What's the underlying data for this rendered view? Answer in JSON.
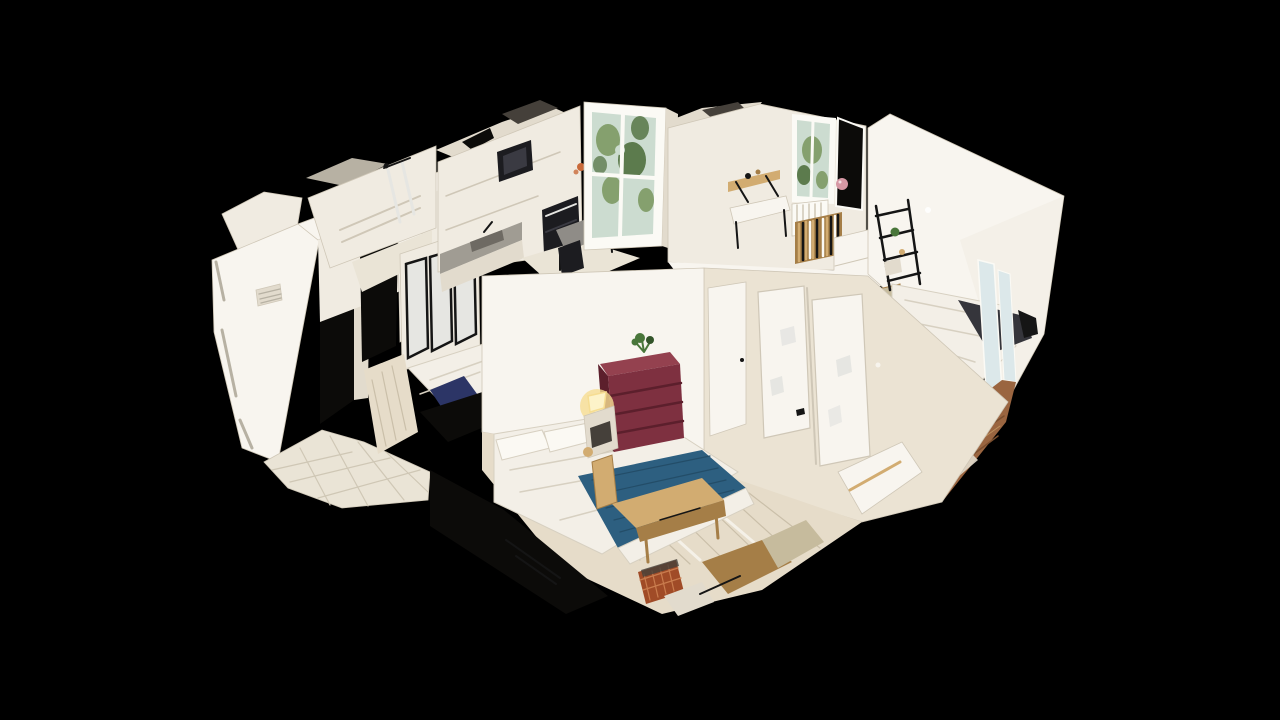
{
  "meta": {
    "app": "3D apartment scan viewer",
    "description": "Dollhouse cutaway 3D scan of an apartment seen from above on a black background",
    "view_mode": "dollhouse",
    "canvas": {
      "width": 1280,
      "height": 720
    }
  },
  "scene": {
    "rooms": [
      "kitchen",
      "office-room",
      "bathroom",
      "entry-hall",
      "glass-partition-bedroom",
      "main-bedroom",
      "right-bedroom",
      "hallway-wardrobe"
    ],
    "objects": [
      "kitchen cabinets",
      "built-in microwave",
      "built-in oven",
      "kitchen window with garden view",
      "dining table with chair",
      "office window with garden view",
      "wall-mounted desk",
      "bookshelf",
      "radiator",
      "glass partition wall",
      "single bed with navy duvet",
      "bathroom shower",
      "entry tiled floor",
      "wall vent",
      "double bed with white duvet",
      "blue throw blanket",
      "burgundy chest of drawers",
      "potted plant",
      "lit bedside lamp",
      "wooden bench",
      "wire storage basket",
      "wardrobe doors",
      "black ladder shelf",
      "bed with charcoal blanket",
      "brown wooden floor",
      "vertical radiator",
      "pink balloon"
    ]
  },
  "palette": {
    "bg": "#000000",
    "wall_bright": "#f8f5ef",
    "wall_light": "#f0ebe1",
    "wall_mid": "#e2dbcd",
    "wall_cream": "#ebe3d3",
    "wall_shadow": "#cfc7b7",
    "ceiling_gray": "#b7b1a3",
    "torn_dark": "#45403a",
    "opening_dark": "#0c0b09",
    "window_frame": "#fbfaf5",
    "window_glass": "#ccdcd0",
    "foliage_mid": "#85a06e",
    "foliage_dark": "#5c7b4d",
    "appliance_black": "#1c1c20",
    "appliance_face": "#3a3a42",
    "counter_gray": "#a09c93",
    "table_gray": "#8f8c87",
    "sink_gray": "#6e6a63",
    "floor_tile": "#eae4d6",
    "grout": "#cfc7b5",
    "floor_plank_light": "#e6dcc9",
    "plank_line": "#cabfa9",
    "floor_wood_brown": "#9a6540",
    "wood_plank_dark": "#7a4e2e",
    "bed_white": "#f3efe7",
    "bed_fold": "#d7d0c1",
    "pillow_white": "#fbf9f3",
    "blanket_blue": "#2d5f80",
    "blanket_blue_dark": "#234d68",
    "blanket_navy": "#2c3566",
    "blanket_charcoal": "#35353b",
    "dresser_maroon": "#7e3040",
    "dresser_maroon_top": "#94414f",
    "dresser_maroon_dark": "#5c1f2c",
    "lamp_glow": "#f6dd92",
    "lamp_core": "#fdf3c9",
    "plant_green": "#49763a",
    "plant_green_dark": "#33552a",
    "wood_tan": "#d2ac71",
    "wood_tan_dark": "#a57e47",
    "basket_rust": "#a04b27",
    "basket_rust_light": "#c97c4e",
    "metal_black": "#151515",
    "radiator_blue": "#dce8ea",
    "khaki_panel": "#c6bb9d",
    "glass_streak": "#e6e6e2",
    "flower_orange": "#c96a3a",
    "balloon_pink": "#d698a4",
    "flare_white": "#ffffff"
  }
}
